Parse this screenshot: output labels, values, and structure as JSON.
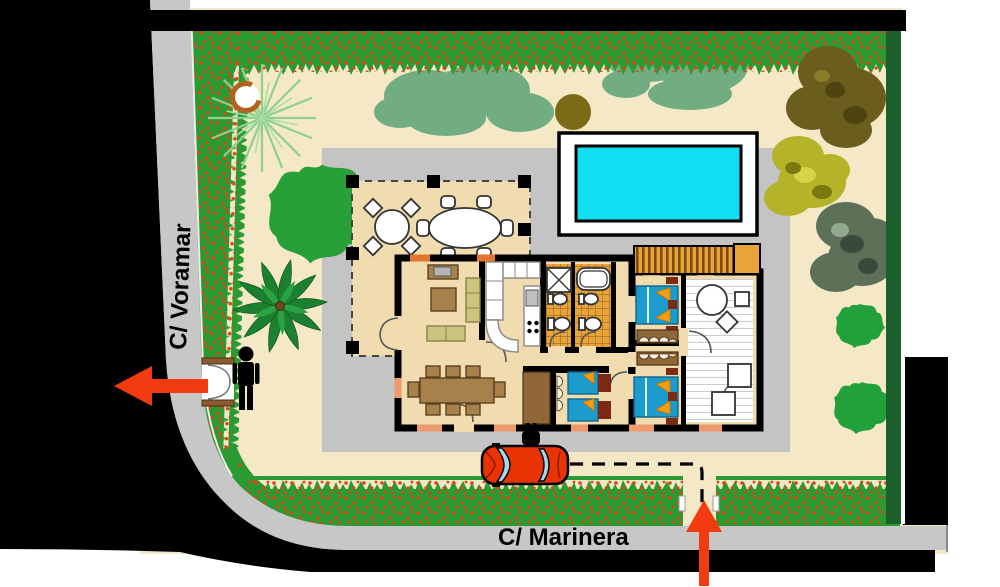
{
  "plan": {
    "streets": {
      "left_label": "C/ Voramar",
      "bottom_label": "C/ Marinera"
    },
    "colors": {
      "surround_black": "#000000",
      "road_gray": "#c7c7c7",
      "plot_cream": "#f4e8c6",
      "paving_gray": "#c4c4c4",
      "hedge_green": "#2c9a33",
      "hedge_berry_red": "#e84012",
      "boundary_hedge_green": "#1b5f2d",
      "pool_water_cyan": "#10dff2",
      "pool_deck_white": "#ffffff",
      "house_floor_tan": "#f1dcb0",
      "wall_black": "#000000",
      "bathroom_tile_orange": "#e8a33b",
      "bed_blue": "#1b9ccc",
      "pillow_orange": "#f59d0e",
      "furniture_wood_brown": "#a6814c",
      "sofa_olive": "#cbc47e",
      "car_red": "#e93305",
      "entrance_arrow_red": "#f23b10",
      "tree_canopy_sage": "#71ad80",
      "palm_green": "#1d8030",
      "pergola_orange": "#e8a33b"
    },
    "icons": {
      "pedestrian": "person-silhouette",
      "ev_charger": "power-plug",
      "pedestrian_entrance": "red-arrow-left",
      "vehicle_entrance": "red-arrow-up",
      "driveway_route": "dashed-path"
    }
  }
}
